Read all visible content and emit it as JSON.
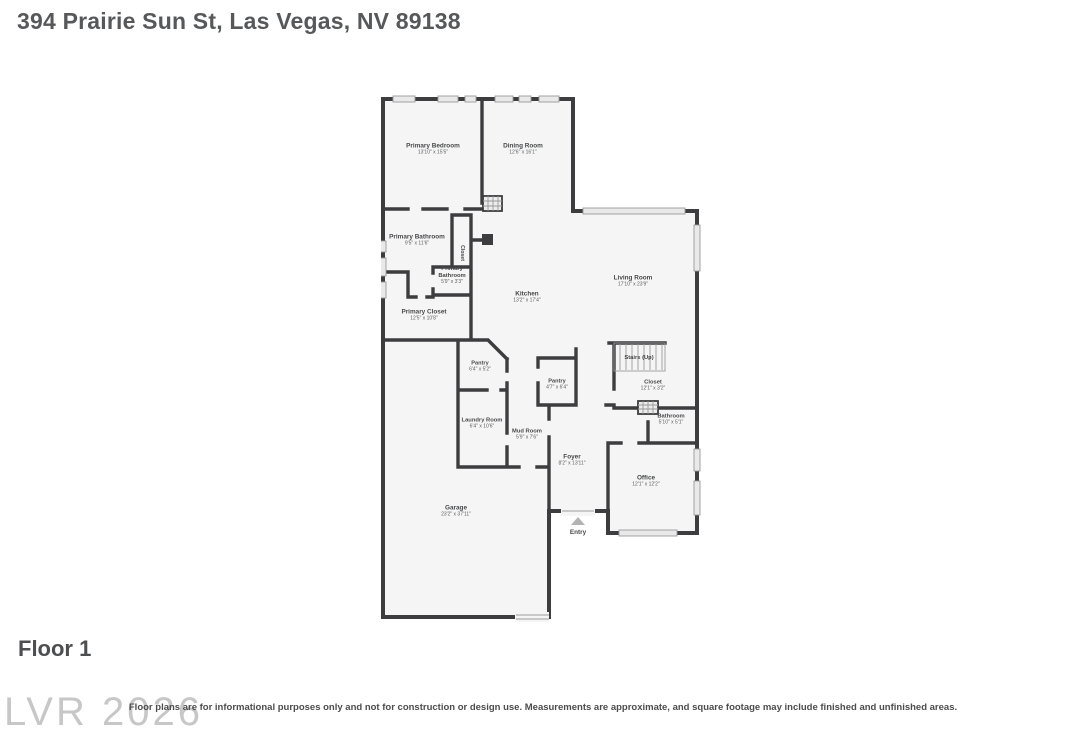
{
  "page": {
    "title": "394 Prairie Sun St, Las Vegas, NV 89138",
    "floor_label": "Floor 1",
    "watermark": "LVR 2026",
    "disclaimer": "Floor plans are for informational purposes only and not for construction or design use. Measurements are approximate, and square footage may include finished and unfinished areas."
  },
  "floorplan": {
    "colors": {
      "wall": "#3d3d3f",
      "floor": "#f5f5f6",
      "label": "#474849",
      "dims": "#5c5d5e",
      "window": "#e9e9ea"
    },
    "rooms": [
      {
        "label": "Primary Bedroom",
        "dims": "13'10\" x 15'5\"",
        "x": 52,
        "y": 58
      },
      {
        "label": "Dining Room",
        "dims": "12'6\" x 16'1\"",
        "x": 142,
        "y": 58
      },
      {
        "label": "Living Room",
        "dims": "17'10\" x 23'9\"",
        "x": 252,
        "y": 190
      },
      {
        "label": "Primary Bathroom",
        "dims": "9'5\" x 11'6\"",
        "x": 36,
        "y": 149
      },
      {
        "label": "Closet",
        "dims": "",
        "x": 80,
        "y": 160,
        "rotate": 90,
        "size": 5.2
      },
      {
        "label": "Primary\nBathroom",
        "dims": "5'9\" x 3'3\"",
        "x": 71,
        "y": 184,
        "size": 5.8
      },
      {
        "label": "Primary Closet",
        "dims": "12'5\" x 10'8\"",
        "x": 43,
        "y": 224
      },
      {
        "label": "Kitchen",
        "dims": "13'2\" x 17'4\"",
        "x": 146,
        "y": 206
      },
      {
        "label": "Pantry",
        "dims": "6'4\" x 5'2\"",
        "x": 99,
        "y": 275,
        "size": 5.6
      },
      {
        "label": "Pantry",
        "dims": "4'7\" x 6'4\"",
        "x": 176,
        "y": 293,
        "size": 5.6
      },
      {
        "label": "Stairs (Up)",
        "dims": "",
        "x": 258,
        "y": 266,
        "size": 5.8
      },
      {
        "label": "Closet",
        "dims": "12'1\" x 3'2\"",
        "x": 272,
        "y": 294,
        "size": 5.8
      },
      {
        "label": "Bathroom",
        "dims": "5'10\" x 5'1\"",
        "x": 290,
        "y": 328,
        "size": 5.8
      },
      {
        "label": "Laundry Room",
        "dims": "6'4\" x 10'6\"",
        "x": 101,
        "y": 332,
        "size": 5.8
      },
      {
        "label": "Mud Room",
        "dims": "5'9\" x 7'6\"",
        "x": 146,
        "y": 343,
        "size": 5.8
      },
      {
        "label": "Foyer",
        "dims": "8'2\" x 13'11\"",
        "x": 191,
        "y": 369
      },
      {
        "label": "Office",
        "dims": "12'1\" x 12'2\"",
        "x": 265,
        "y": 390
      },
      {
        "label": "Garage",
        "dims": "23'2\" x 37'11\"",
        "x": 75,
        "y": 420
      },
      {
        "label": "Entry",
        "dims": "",
        "x": 197,
        "y": 441
      }
    ]
  }
}
